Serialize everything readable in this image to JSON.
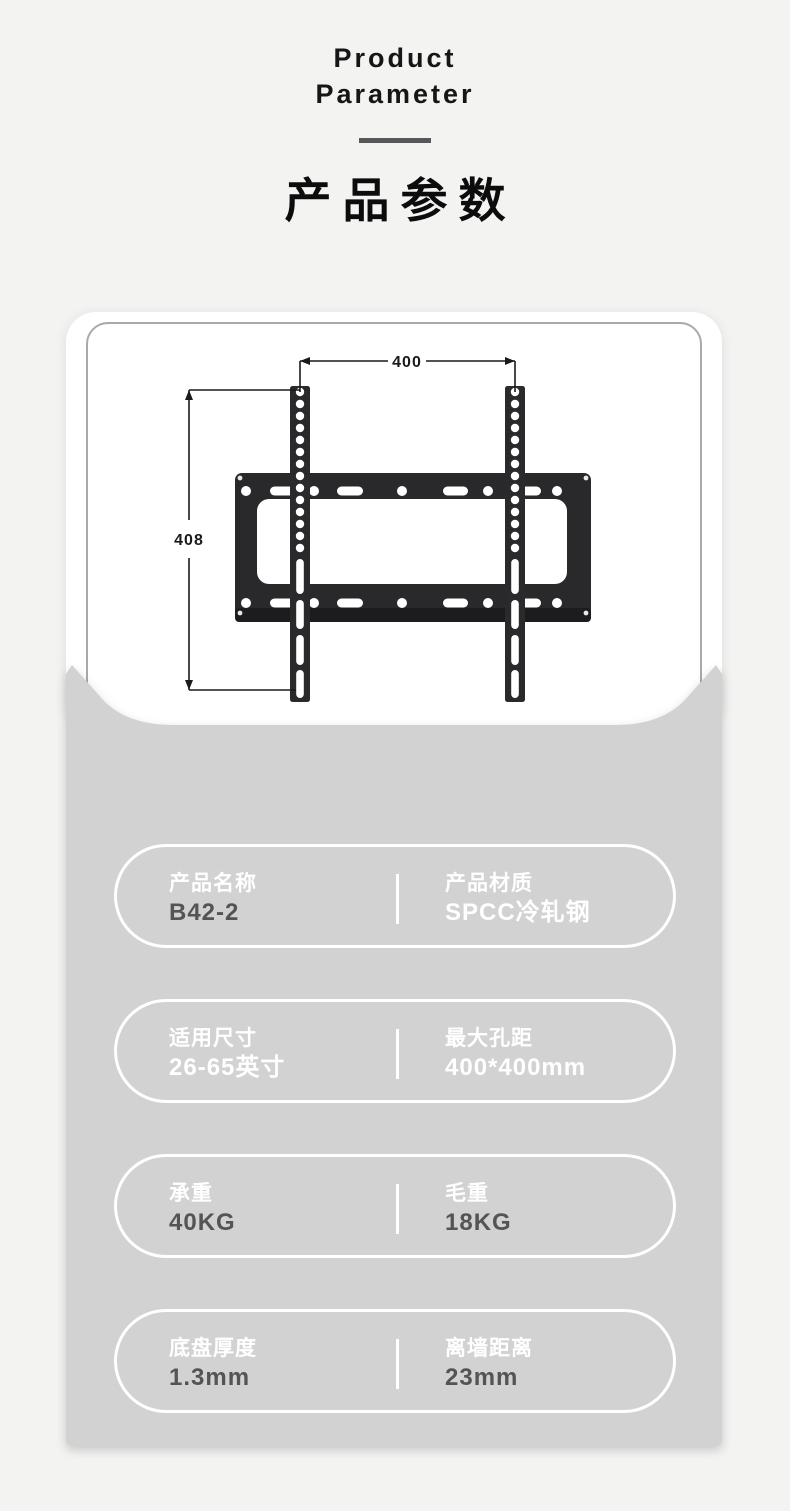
{
  "header": {
    "title_en_line1": "Product",
    "title_en_line2": "Parameter",
    "title_zh": "产品参数"
  },
  "diagram": {
    "horizontal_dimension": "400",
    "vertical_dimension": "408"
  },
  "specs": {
    "rows": [
      {
        "left": {
          "label": "产品名称",
          "value": "B42-2"
        },
        "right": {
          "label": "产品材质",
          "value": "SPCC冷轧钢"
        }
      },
      {
        "left": {
          "label": "适用尺寸",
          "value": "26-65英寸"
        },
        "right": {
          "label": "最大孔距",
          "value": "400*400mm"
        }
      },
      {
        "left": {
          "label": "承重",
          "value": "40KG"
        },
        "right": {
          "label": "毛重",
          "value": "18KG"
        }
      },
      {
        "left": {
          "label": "底盘厚度",
          "value": "1.3mm"
        },
        "right": {
          "label": "离墙距离",
          "value": "23mm"
        }
      }
    ]
  },
  "colors": {
    "page_bg": "#f3f3f2",
    "card_bg": "#ffffff",
    "envelope_gray": "#d2d2d2",
    "bracket_dark": "#2a2a2c",
    "accent_bar": "#57575a",
    "value_dark_text": "#545456",
    "label_light_text": "#ffffff",
    "dimension_line": "#1a1a1a",
    "frame_border": "#a9a9a9"
  }
}
